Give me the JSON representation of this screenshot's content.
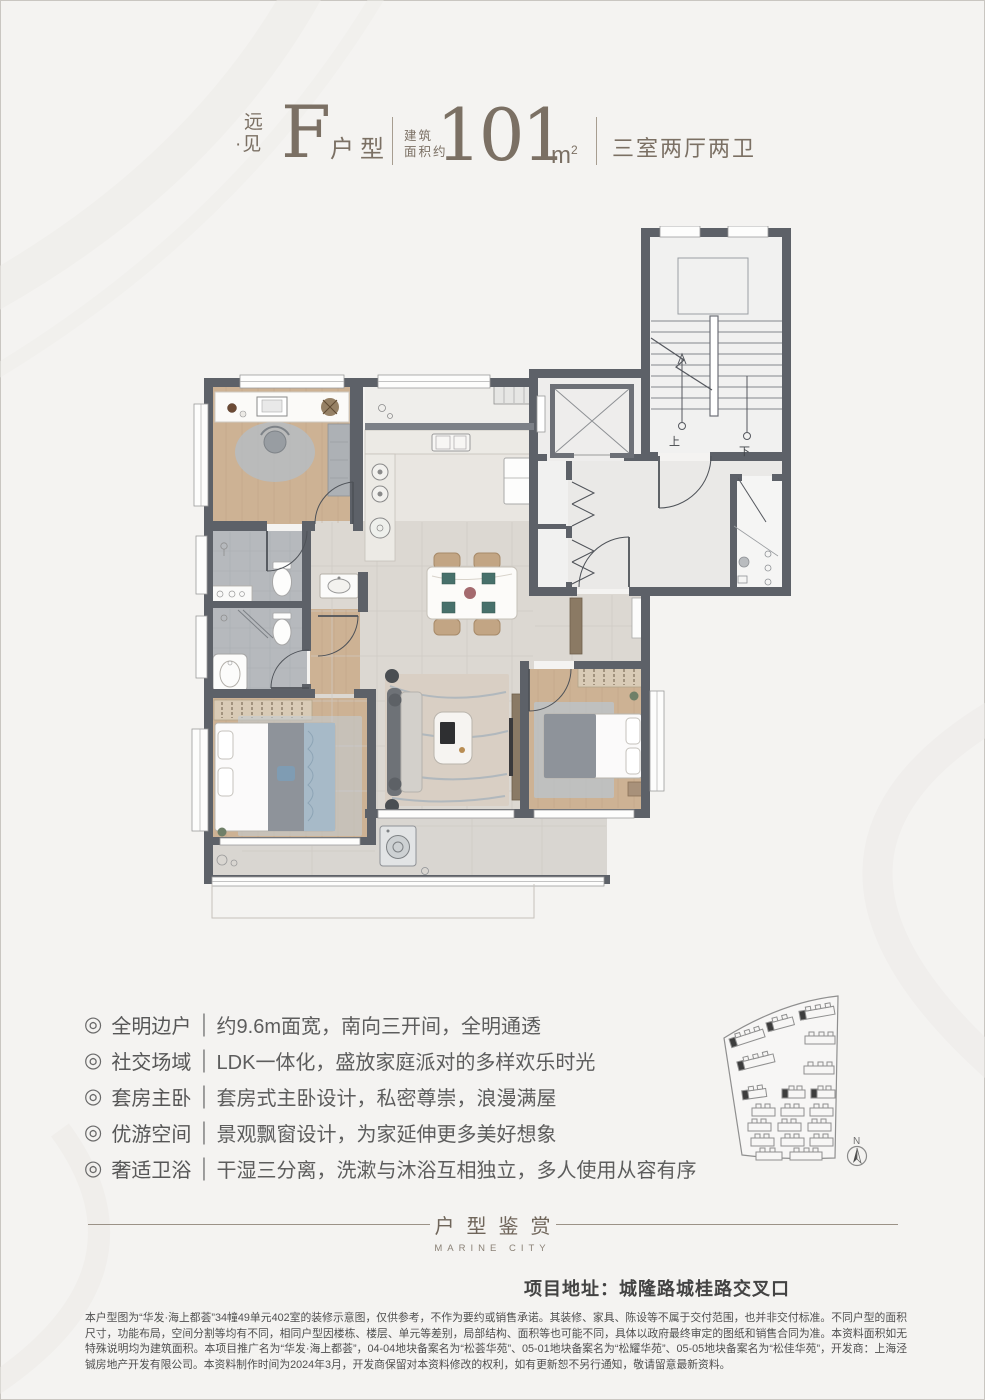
{
  "header": {
    "series_top": "远",
    "series_dot": "·",
    "series_bottom": "见",
    "plan_letter": "F",
    "plan_suffix": "户型",
    "area_label_line1": "建筑",
    "area_label_line2": "面积约",
    "area_value": "101",
    "area_unit_base": "m",
    "area_unit_sup": "2",
    "rooms_summary": "三室两厅两卫"
  },
  "features": {
    "bullet": "◎",
    "separator": "|",
    "items": [
      {
        "label": "全明边户",
        "desc": "约9.6m面宽，南向三开间，全明通透"
      },
      {
        "label": "社交场域",
        "desc": "LDK一体化，盛放家庭派对的多样欢乐时光"
      },
      {
        "label": "套房主卧",
        "desc": "套房式主卧设计，私密尊崇，浪漫满屋"
      },
      {
        "label": "优游空间",
        "desc": "景观飘窗设计，为家延伸更多美好想象"
      },
      {
        "label": "奢适卫浴",
        "desc": "干湿三分离，洗漱与沐浴互相独立，多人使用从容有序"
      }
    ]
  },
  "section_divider": {
    "title": "户型鉴赏",
    "subtitle": "MARINE CITY"
  },
  "address": "项目地址：城隆路城桂路交叉口",
  "disclaimer": "本户型图为“华发·海上都荟”34幢49单元402室的装修示意图，仅供参考，不作为要约或销售承诺。其装修、家具、陈设等不属于交付范围，也并非交付标准。不同户型的面积尺寸，功能布局，空间分割等均有不同，相同户型因楼栋、楼层、单元等差别，局部结构、面积等也可能不同，具体以政府最终审定的图纸和销售合同为准。本资料面积如无特殊说明均为建筑面积。本项目推广名为“华发·海上都荟”，04-04地块备案名为“松荟华苑”、05-01地块备案名为“松耀华苑”、05-05地块备案名为“松佳华苑”，开发商：上海泾铖房地产开发有限公司。本资料制作时间为2024年3月，开发商保留对本资料修改的权利，如有更新恕不另行通知，敬请留意最新资料。",
  "floorplan": {
    "stairs_up": "上",
    "stairs_down": "下"
  },
  "sitemap": {
    "compass": "N"
  },
  "colors": {
    "accent": "#7b7064",
    "wall": "#5d6168",
    "text_gray": "#5d5d5d"
  }
}
